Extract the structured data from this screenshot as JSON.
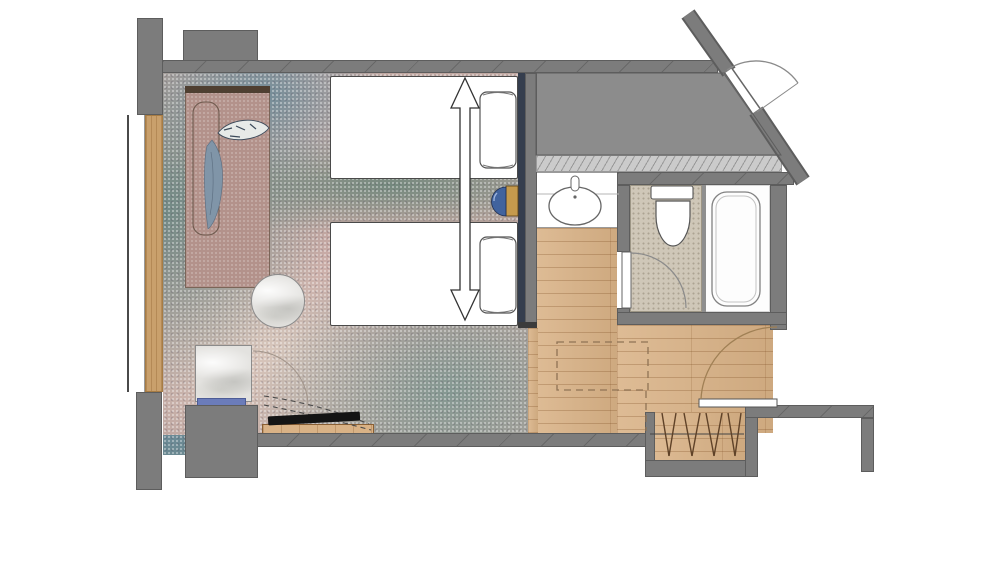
{
  "canvas": {
    "width": 1000,
    "height": 563,
    "background": "#ffffff"
  },
  "drawing_type": "hotel-guestroom-floor-plan",
  "colors": {
    "wall": "#7c7c7c",
    "wall_edge": "#5d5d5d",
    "shaft": "#8c8c8c",
    "shaft_band": "#cbcbcb",
    "carpet_base": "#c0a8a2",
    "wood": "#d9b286",
    "tile": "#cfc7b8",
    "counter_white": "#ffffff",
    "navy": "#353e4e",
    "lamp_blue": "#41639e",
    "lamp_gold": "#c59a4d",
    "daybed": "#b3928b",
    "daybed_trim": "#4f3f31",
    "marble": "#e3e2df",
    "bench_blue": "#6b7cba",
    "tv": "#141414",
    "line_dark": "#4a4a4a",
    "arc_line": "#8a8a8a",
    "hanger": "#5f4228",
    "dash_line": "#8f7355",
    "window_wood": "#c9a06c"
  },
  "rooms": [
    "bedroom",
    "window-daybed-zone",
    "vanity-area",
    "toilet-room",
    "bathtub-room",
    "entry-hall",
    "wardrobe-niche",
    "service-shaft"
  ],
  "fixtures": [
    "twin-bed-upper",
    "twin-bed-lower",
    "pillow",
    "bed-joining-arrow",
    "nightstand-lamp",
    "window-daybed",
    "decor-cushion",
    "throw-drape",
    "round-side-table",
    "minibar-cabinet",
    "tv",
    "tv-console",
    "vanity-counter",
    "sink",
    "faucet",
    "toilet",
    "bathtub",
    "toilet-door",
    "entry-door",
    "corridor-door",
    "wardrobe-rod",
    "clothes-hangers",
    "window",
    "window-sill",
    "luggage-space-dashed"
  ]
}
